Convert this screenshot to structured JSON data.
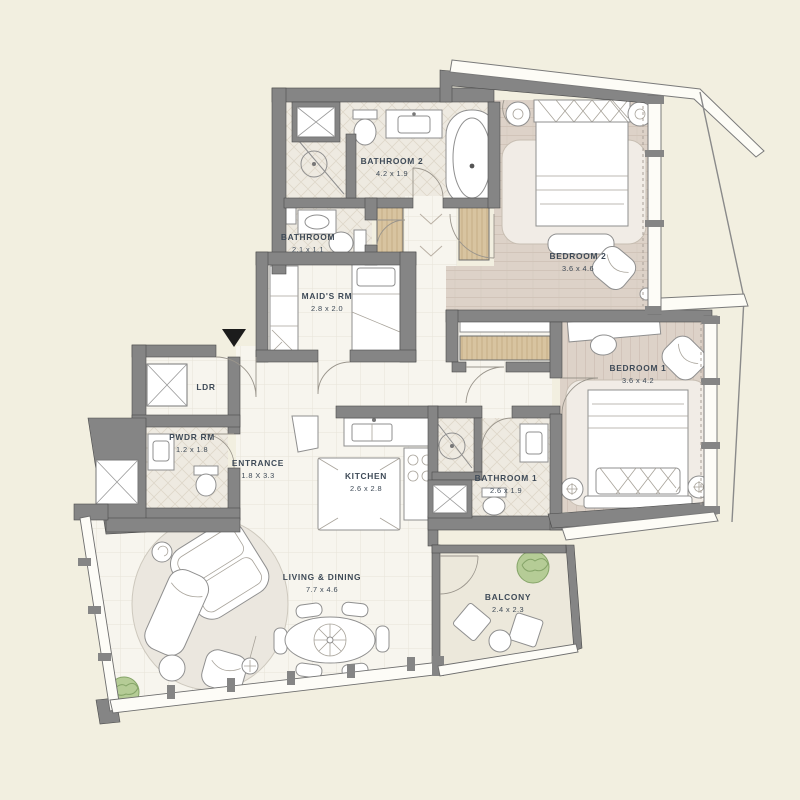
{
  "plan": {
    "rooms": {
      "bathroom2": {
        "name": "BATHROOM 2",
        "dims": "4.2 x 1.9"
      },
      "bathroom": {
        "name": "BATHROOM",
        "dims": "2.1 x 1.1"
      },
      "maids_room": {
        "name": "MAID'S RM",
        "dims": "2.8 x 2.0"
      },
      "bedroom2": {
        "name": "BEDROOM 2",
        "dims": "3.6 x 4.6"
      },
      "bedroom1": {
        "name": "BEDROOM 1",
        "dims": "3.6 x 4.2"
      },
      "ldr": {
        "name": "LDR",
        "dims": ""
      },
      "powder_room": {
        "name": "PWDR RM",
        "dims": "1.2 x 1.8"
      },
      "entrance": {
        "name": "ENTRANCE",
        "dims": "1.8 X 3.3"
      },
      "kitchen": {
        "name": "KITCHEN",
        "dims": "2.6 x 2.8"
      },
      "bathroom1": {
        "name": "BATHROOM 1",
        "dims": "2.6 x 1.9"
      },
      "living_dining": {
        "name": "LIVING & DINING",
        "dims": "7.7 x 4.6"
      },
      "balcony": {
        "name": "BALCONY",
        "dims": "2.4 x 2.3"
      }
    },
    "colors": {
      "background": "#f2efe0",
      "wall": "#858585",
      "floor_tile": "#f7f5ee",
      "floor_wood": "#ddd2c8",
      "wardrobe": "#d8c4a0",
      "bath_tile": "#eeeae1",
      "label": "#3e4a57",
      "plant": "#b5cc96",
      "entry_marker": "#1c1c1c"
    }
  }
}
